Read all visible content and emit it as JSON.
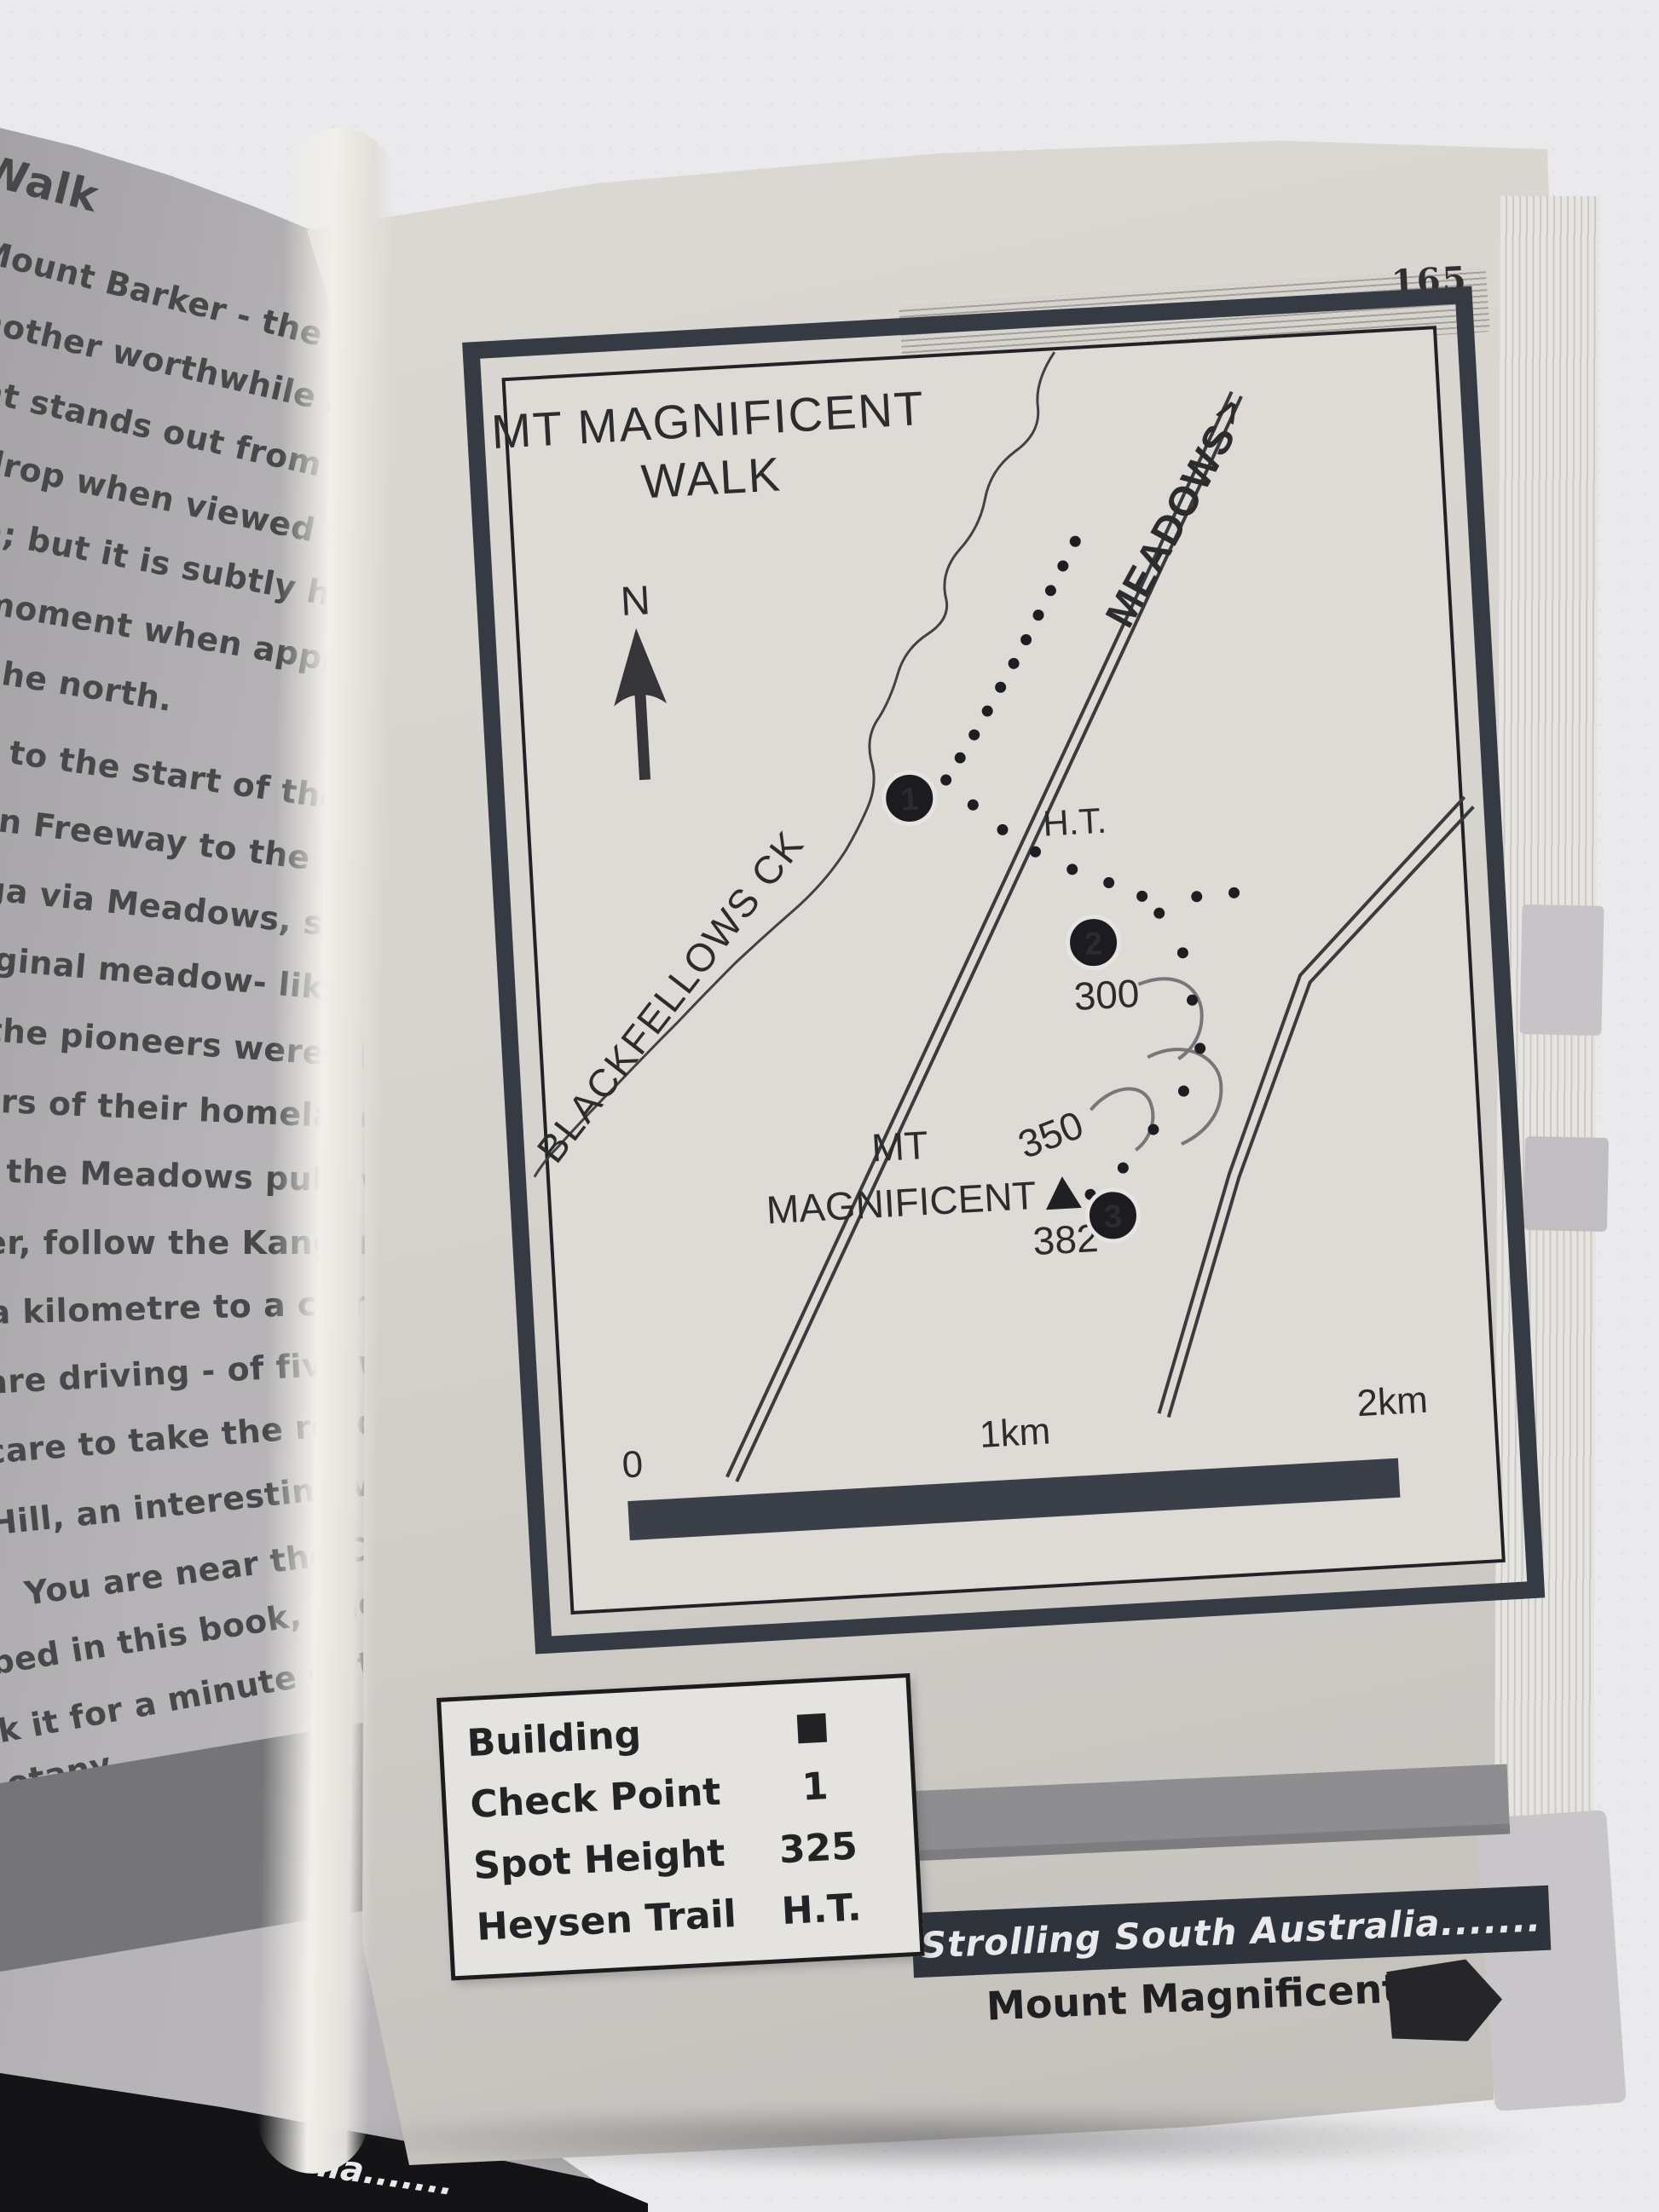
{
  "photo": {
    "page_number": "165"
  },
  "left_page": {
    "heading": "Walk",
    "lines": [
      "Mount Barker - the mountain...",
      "nother worthwhile ascent - M...",
      "nt stands out from the Mou...",
      "drop when viewed from the sou...",
      "a; but it is subtly hidden aw...",
      "moment when approached fro...",
      "he north.",
      "t to the start of the walk, driv...",
      "rn Freeway to the Hahndorf...",
      "ga via Meadows, so pleasantly...",
      "iginal meadow- like appearance...",
      "the pioneers were always look...",
      "rs of their homeland.",
      "the Meadows pub, where we...",
      "er, follow the Kangarilla roa...",
      "a kilometre to a complicated...",
      "are driving - of five ways. Turn...",
      "care to take the road signpos...",
      "Hill, an interesting village with...",
      "You are near the Chookarloo...",
      "bed in this book, and might fin...",
      "k it for a minute or two to...",
      "otany."
    ],
    "footer_fragment": "lia......."
  },
  "map": {
    "title_line1": "MT MAGNIFICENT",
    "title_line2": "WALK",
    "north_label": "N",
    "creek_label": "BLACKFELLOWS CK",
    "road_label": "MEADOWS",
    "road_label_arrow": ">",
    "heysen_label": "H.T.",
    "summit_label_line1": "MT",
    "summit_label_line2": "MAGNIFICENT",
    "spot_heights": [
      "300",
      "350",
      "382"
    ],
    "checkpoints": [
      "1",
      "2",
      "3"
    ],
    "scale_labels": [
      "0",
      "1km",
      "2km"
    ]
  },
  "legend": {
    "rows": [
      {
        "label": "Building",
        "value": "■"
      },
      {
        "label": "Check Point",
        "value": "1"
      },
      {
        "label": "Spot Height",
        "value": "325"
      },
      {
        "label": "Heysen Trail",
        "value": "H.T."
      }
    ]
  },
  "footer": {
    "series_title": "Strolling South Australia.......",
    "walk_title": "Mount Magnificent"
  },
  "colors": {
    "map_frame": "#363a42",
    "footer_band": "#2f333b",
    "paper_gray": "#b3b1b3",
    "paper_cream": "#d7d4cf",
    "ink": "#2c2c2e",
    "band_gray": "#8e8e90",
    "black_band": "#141416"
  }
}
